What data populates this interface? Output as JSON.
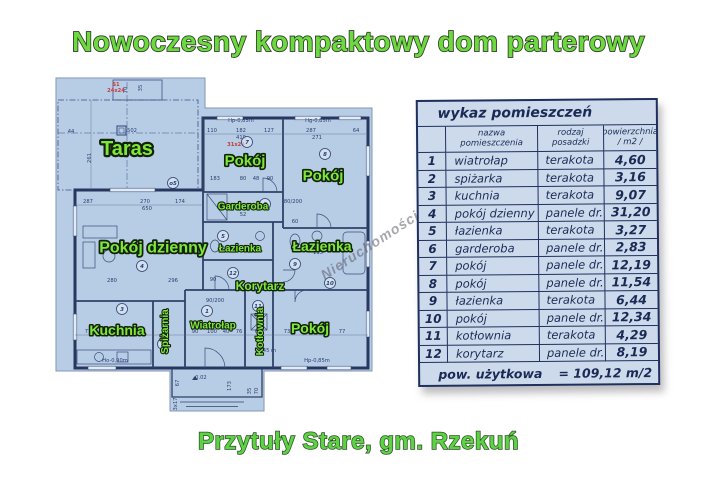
{
  "page": {
    "title": "Nowoczesny kompaktowy dom parterowy",
    "caption": "Przytuły Stare, gm. Rzekuń",
    "watermark": "Nieruchomości Trzciński",
    "colors": {
      "title_green": "#6cd93f",
      "label_green": "#7de83b",
      "paper_blue": "#b7cde6",
      "line_navy": "#2e4168",
      "table_bg": "#ccdaec",
      "table_ink": "#1b2a55",
      "red_annotation": "#c23b3b"
    }
  },
  "table": {
    "title": "wykaz pomieszczeń",
    "header": {
      "no": "",
      "name": "nazwa pomieszczenia",
      "floor": "rodzaj posadzki",
      "area_line1": "powierzchnia",
      "area_line2": "/ m2 /"
    },
    "rows": [
      [
        "1",
        "wiatrołap",
        "terakota",
        "4,60"
      ],
      [
        "2",
        "spiżarka",
        "terakota",
        "3,16"
      ],
      [
        "3",
        "kuchnia",
        "terakota",
        "9,07"
      ],
      [
        "4",
        "pokój dzienny",
        "panele dr.",
        "31,20"
      ],
      [
        "5",
        "łazienka",
        "terakota",
        "3,27"
      ],
      [
        "6",
        "garderoba",
        "panele dr.",
        "2,83"
      ],
      [
        "7",
        "pokój",
        "panele dr.",
        "12,19"
      ],
      [
        "8",
        "pokój",
        "panele dr.",
        "11,54"
      ],
      [
        "9",
        "łazienka",
        "terakota",
        "6,44"
      ],
      [
        "10",
        "pokój",
        "panele dr.",
        "12,34"
      ],
      [
        "11",
        "kotłownia",
        "terakota",
        "4,29"
      ],
      [
        "12",
        "korytarz",
        "panele dr.",
        "8,19"
      ]
    ],
    "footer": {
      "label": "pow. użytkowa",
      "value": "= 109,12 m/2"
    }
  },
  "plan": {
    "rooms": [
      {
        "label": "Taras",
        "x": 72,
        "y": 72,
        "size": 20
      },
      {
        "label": "Pokój",
        "x": 190,
        "y": 84,
        "size": 15
      },
      {
        "label": "Pokój",
        "x": 268,
        "y": 99,
        "size": 15
      },
      {
        "label": "Garderoba",
        "x": 188,
        "y": 130,
        "size": 10
      },
      {
        "label": "Pokój dzienny",
        "x": 98,
        "y": 171,
        "size": 16
      },
      {
        "label": "Łazienka",
        "x": 185,
        "y": 172,
        "size": 10
      },
      {
        "label": "Łazienka",
        "x": 267,
        "y": 170,
        "size": 14
      },
      {
        "label": "Korytarz",
        "x": 205,
        "y": 210,
        "size": 12
      },
      {
        "label": "Kuchnia",
        "x": 62,
        "y": 254,
        "size": 14
      },
      {
        "label": "Spiżarnia",
        "x": 113,
        "y": 252,
        "size": 10,
        "rot": -90
      },
      {
        "label": "Wiatrołap",
        "x": 158,
        "y": 249,
        "size": 10
      },
      {
        "label": "Kotłownia",
        "x": 208,
        "y": 252,
        "size": 10,
        "rot": -90
      },
      {
        "label": "Pokój",
        "x": 255,
        "y": 252,
        "size": 14
      }
    ],
    "circled_numbers": [
      {
        "n": "o5",
        "x": 118,
        "y": 107
      },
      {
        "n": "7",
        "x": 192,
        "y": 66
      },
      {
        "n": "8",
        "x": 270,
        "y": 78
      },
      {
        "n": "6",
        "x": 210,
        "y": 128
      },
      {
        "n": "4",
        "x": 87,
        "y": 190
      },
      {
        "n": "5",
        "x": 168,
        "y": 160
      },
      {
        "n": "9",
        "x": 240,
        "y": 188
      },
      {
        "n": "12",
        "x": 178,
        "y": 197
      },
      {
        "n": "3",
        "x": 67,
        "y": 233
      },
      {
        "n": "1",
        "x": 152,
        "y": 235
      },
      {
        "n": "2",
        "x": 108,
        "y": 268
      },
      {
        "n": "11",
        "x": 203,
        "y": 230
      },
      {
        "n": "10",
        "x": 275,
        "y": 207
      }
    ],
    "dimensions": [
      {
        "t": "502",
        "x": 77,
        "y": 56
      },
      {
        "t": "261",
        "x": 36,
        "y": 82,
        "r": -90
      },
      {
        "t": "44",
        "x": 16,
        "y": 57
      },
      {
        "t": "70",
        "x": 72,
        "y": 14,
        "r": -90
      },
      {
        "t": "35",
        "x": 87,
        "y": 12,
        "r": -90
      },
      {
        "t": "110",
        "x": 157,
        "y": 56
      },
      {
        "t": "182",
        "x": 186,
        "y": 56
      },
      {
        "t": "127",
        "x": 214,
        "y": 56
      },
      {
        "t": "287",
        "x": 256,
        "y": 56
      },
      {
        "t": "64",
        "x": 301,
        "y": 56
      },
      {
        "t": "419",
        "x": 186,
        "y": 63
      },
      {
        "t": "271",
        "x": 262,
        "y": 63
      },
      {
        "t": "Hp-0,85m",
        "x": 186,
        "y": 46
      },
      {
        "t": "Hg-0,85m",
        "x": 263,
        "y": 46
      },
      {
        "t": "183",
        "x": 160,
        "y": 104
      },
      {
        "t": "80",
        "x": 188,
        "y": 104
      },
      {
        "t": "48",
        "x": 201,
        "y": 104
      },
      {
        "t": "90",
        "x": 215,
        "y": 104
      },
      {
        "t": "287",
        "x": 33,
        "y": 127
      },
      {
        "t": "270",
        "x": 90,
        "y": 127
      },
      {
        "t": "174",
        "x": 125,
        "y": 127
      },
      {
        "t": "650",
        "x": 92,
        "y": 134
      },
      {
        "t": "280",
        "x": 57,
        "y": 206
      },
      {
        "t": "296",
        "x": 118,
        "y": 206
      },
      {
        "t": "90",
        "x": 158,
        "y": 205
      },
      {
        "t": "52",
        "x": 188,
        "y": 140
      },
      {
        "t": "182",
        "x": 186,
        "y": 176
      },
      {
        "t": "115",
        "x": 263,
        "y": 178
      },
      {
        "t": "80/200",
        "x": 238,
        "y": 127
      },
      {
        "t": "90/200",
        "x": 160,
        "y": 226
      },
      {
        "t": "60",
        "x": 240,
        "y": 147
      },
      {
        "t": "77",
        "x": 33,
        "y": 257
      },
      {
        "t": "180",
        "x": 60,
        "y": 257
      },
      {
        "t": "84",
        "x": 86,
        "y": 257
      },
      {
        "t": "90",
        "x": 140,
        "y": 257
      },
      {
        "t": "100",
        "x": 157,
        "y": 257
      },
      {
        "t": "40",
        "x": 171,
        "y": 257
      },
      {
        "t": "76",
        "x": 184,
        "y": 257
      },
      {
        "t": "60",
        "x": 203,
        "y": 257
      },
      {
        "t": "73",
        "x": 232,
        "y": 257
      },
      {
        "t": "180",
        "x": 253,
        "y": 257
      },
      {
        "t": "77",
        "x": 287,
        "y": 257
      },
      {
        "t": "1,45 m",
        "x": 212,
        "y": 276
      },
      {
        "t": "Ho-0,90m",
        "x": 60,
        "y": 286
      },
      {
        "t": "Hp-0,85m",
        "x": 262,
        "y": 286
      },
      {
        "t": "-0.02",
        "x": 145,
        "y": 303
      },
      {
        "t": "67",
        "x": 124,
        "y": 307,
        "r": -90
      },
      {
        "t": "173",
        "x": 176,
        "y": 310,
        "r": -90
      },
      {
        "t": "3x17",
        "x": 122,
        "y": 328,
        "r": -90
      },
      {
        "t": "35",
        "x": 196,
        "y": 315,
        "r": -90
      },
      {
        "t": "70",
        "x": 203,
        "y": 315,
        "r": -90
      }
    ],
    "red_marks": [
      {
        "t": "S1",
        "x": 61,
        "y": 10
      },
      {
        "t": "24x24",
        "x": 61,
        "y": 16
      },
      {
        "t": "31x24",
        "x": 181,
        "y": 70
      }
    ]
  }
}
